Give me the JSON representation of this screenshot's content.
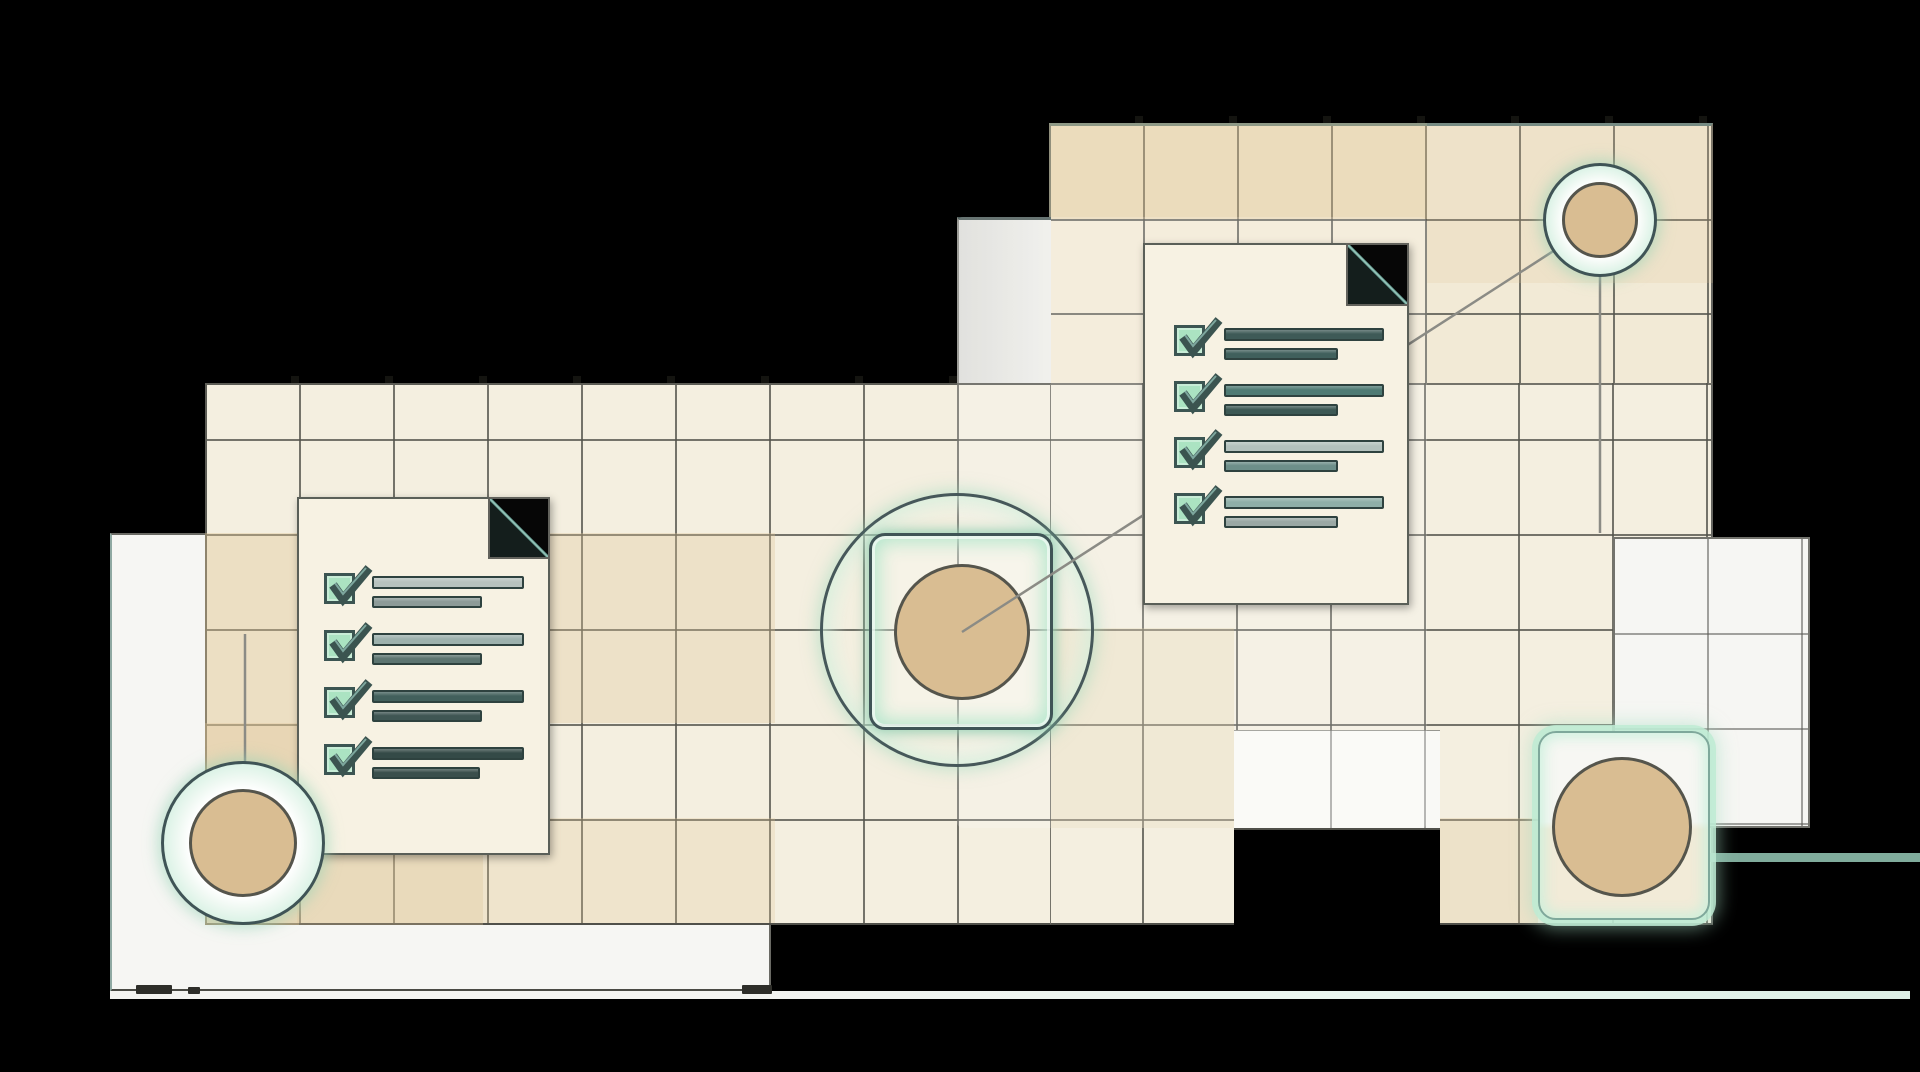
{
  "palette": {
    "background": "#000000",
    "panel_cream": "#f4efe0",
    "panel_cream_warm": "#f2ead6",
    "panel_white": "#f6f6f3",
    "grid_line": "rgba(84,84,76,0.8)",
    "warm_cell": "rgba(223,196,148,0.38)",
    "outline_dark": "#3f5456",
    "teal_border": "#5c7e7f",
    "mint_glow": "#cdeedd",
    "node_tan": "#d9bd92",
    "node_tan_outline": "#55554c",
    "connector": "#8b8b85",
    "checkbox_fill": "#abe3c2",
    "check_stroke": "#3b5450",
    "bar_outline": "#2e423f",
    "document_fill": "#f7f2e3",
    "document_border": "#5a5f58",
    "fold_edge": "#5f958c",
    "gray_column": "#e6e6e2",
    "teal_beam": "#87b5a4",
    "floor_line": "#eaf7f0"
  },
  "nodes": [
    {
      "id": "top-right-circle",
      "shape": "circle"
    },
    {
      "id": "center-circle",
      "shape": "circle-in-rounded-square"
    },
    {
      "id": "bottom-left-circle",
      "shape": "circle"
    },
    {
      "id": "bottom-right-square",
      "shape": "circle-in-glow-square"
    }
  ],
  "checklists": {
    "left": {
      "items": [
        {
          "checked": true,
          "bars": [
            {
              "width": 152,
              "color": "#b7c2be"
            },
            {
              "width": 110,
              "color": "#8d9b98"
            }
          ]
        },
        {
          "checked": true,
          "bars": [
            {
              "width": 152,
              "color": "#9db1ad"
            },
            {
              "width": 110,
              "color": "#5d7571"
            }
          ]
        },
        {
          "checked": true,
          "bars": [
            {
              "width": 152,
              "color": "#42605c"
            },
            {
              "width": 110,
              "color": "#3f5653"
            }
          ]
        },
        {
          "checked": true,
          "bars": [
            {
              "width": 152,
              "color": "#344a47"
            },
            {
              "width": 108,
              "color": "#3a4f4c"
            }
          ]
        }
      ]
    },
    "right": {
      "items": [
        {
          "checked": true,
          "bars": [
            {
              "width": 160,
              "color": "#3e5a57"
            },
            {
              "width": 114,
              "color": "#40605c"
            }
          ]
        },
        {
          "checked": true,
          "bars": [
            {
              "width": 160,
              "color": "#4e7a73"
            },
            {
              "width": 114,
              "color": "#3d5955"
            }
          ]
        },
        {
          "checked": true,
          "bars": [
            {
              "width": 160,
              "color": "#b3c1bd"
            },
            {
              "width": 114,
              "color": "#6d8f89"
            }
          ]
        },
        {
          "checked": true,
          "bars": [
            {
              "width": 160,
              "color": "#8fafa8"
            },
            {
              "width": 114,
              "color": "#9aa8a4"
            }
          ]
        }
      ]
    }
  }
}
